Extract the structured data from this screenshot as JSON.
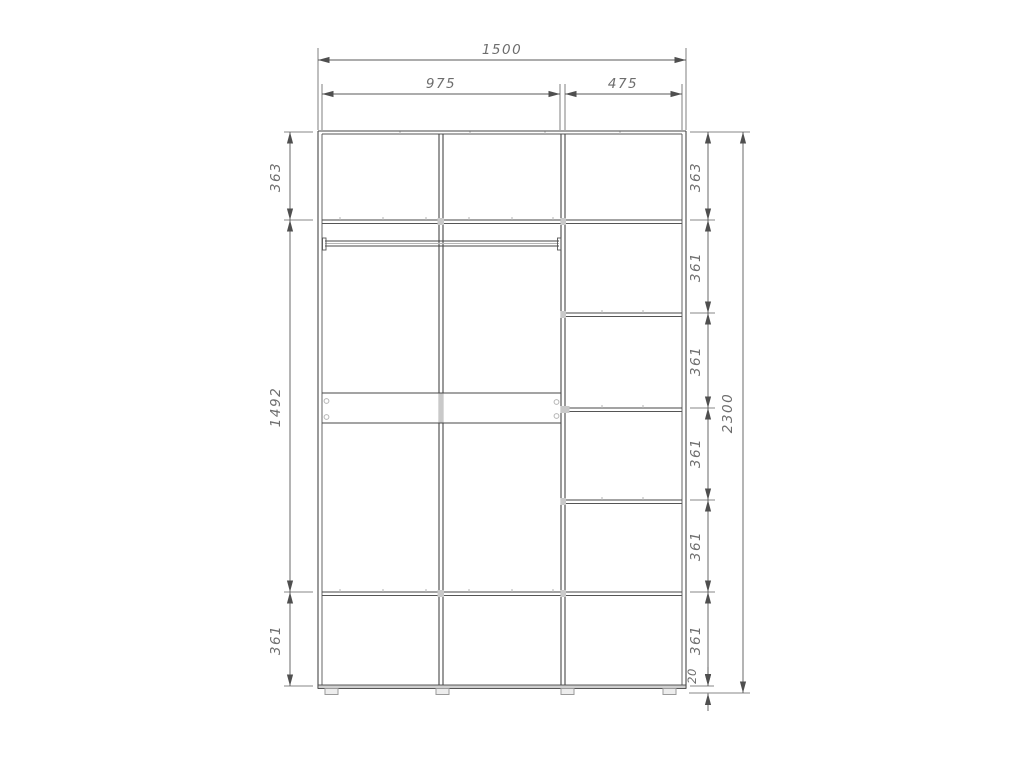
{
  "drawing": {
    "type": "furniture-dimension-diagram",
    "subject": "wardrobe front elevation with chain dimensions",
    "units": "mm",
    "colors": {
      "background": "#ffffff",
      "structure_line": "#474747",
      "dimension_line": "#5a5a5a",
      "text": "#6d6d6d",
      "accent_gray": "#c9c9c9"
    },
    "dims": {
      "total_width": "1500",
      "left_section_width": "975",
      "right_section_width": "475",
      "left_rows": [
        "363",
        "1492",
        "361"
      ],
      "right_rows": [
        "363",
        "361",
        "361",
        "361",
        "361",
        "361"
      ],
      "total_height": "2300",
      "plinth_height": "20"
    }
  }
}
